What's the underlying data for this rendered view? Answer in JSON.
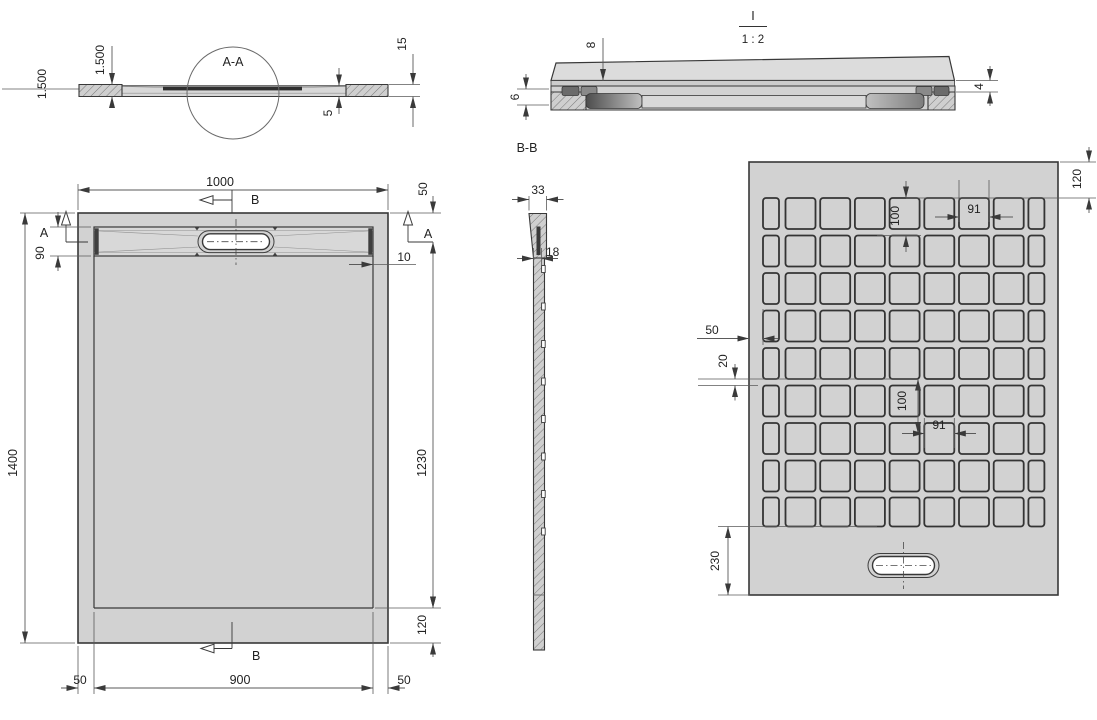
{
  "colors": {
    "plate": "#d2d2d2",
    "line": "#383838",
    "dim_line": "#5a5a5a",
    "drain_fill": "#ffffff",
    "dark_insert": "#3f3f3f"
  },
  "section_aa": {
    "label": "A-A",
    "slope_outer": "1.500",
    "slope_inner": "1.500",
    "step": "5",
    "edge": "15"
  },
  "detail_i": {
    "label": "I",
    "scale": "1 : 2",
    "top_thickness": "8",
    "base_left": "6",
    "base_right": "4"
  },
  "section_bb": {
    "label": "B-B",
    "top_width": "33",
    "thickness": "18"
  },
  "plan": {
    "width": "1000",
    "height": "1400",
    "inner_height": "1230",
    "bottom_margin": "120",
    "top_offset": "50",
    "channel_depth": "90",
    "wall_thickness": "10",
    "foot_left": "50",
    "foot_center": "900",
    "foot_right": "50",
    "cut_a": "A",
    "cut_b": "B"
  },
  "bottom": {
    "top_margin": "120",
    "row_pitch": "100",
    "square_width": "91",
    "edge_offset": "50",
    "gap": "20",
    "mid_pitch": "100",
    "mid_square": "91",
    "drain_offset": "230",
    "grid_rows": 9,
    "grid_cols": 9
  }
}
